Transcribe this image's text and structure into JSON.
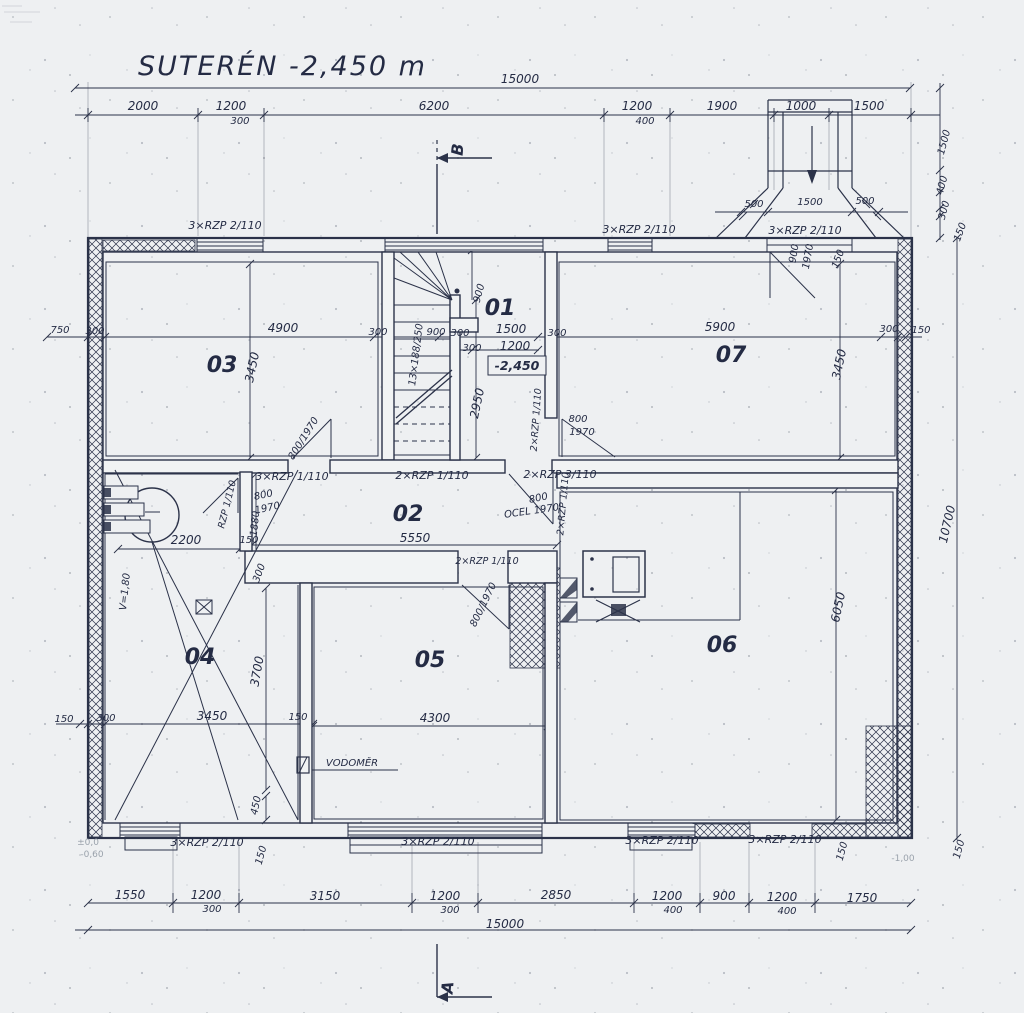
{
  "drawing": {
    "title": "SUTERÉN  -2,450 m",
    "level_mark": "-2,450",
    "room_numbers": [
      "01",
      "02",
      "03",
      "04",
      "05",
      "06",
      "07"
    ],
    "overall_width_mm": "15000",
    "overall_height_mm": "10700",
    "ink_color": "#2b3249",
    "paper_color": "#eef0f2"
  },
  "labels": [
    {
      "t": "SUTERÉN  -2,450 m",
      "x": 138,
      "y": 75,
      "c": "title",
      "n": "drawing-title"
    },
    {
      "t": "15000",
      "x": 520,
      "y": 83,
      "c": "dim"
    },
    {
      "t": "2000",
      "x": 143,
      "y": 110,
      "c": "dim"
    },
    {
      "t": "1200",
      "x": 231,
      "y": 110,
      "c": "dim"
    },
    {
      "t": "300",
      "x": 240,
      "y": 124,
      "c": "dimS"
    },
    {
      "t": "6200",
      "x": 434,
      "y": 110,
      "c": "dim"
    },
    {
      "t": "1200",
      "x": 637,
      "y": 110,
      "c": "dim"
    },
    {
      "t": "400",
      "x": 645,
      "y": 124,
      "c": "dimS"
    },
    {
      "t": "1900",
      "x": 722,
      "y": 110,
      "c": "dim"
    },
    {
      "t": "1000",
      "x": 801,
      "y": 110,
      "c": "dim"
    },
    {
      "t": "1500",
      "x": 869,
      "y": 110,
      "c": "dim"
    },
    {
      "t": "500",
      "x": 754,
      "y": 207,
      "c": "dimS"
    },
    {
      "t": "1500",
      "x": 810,
      "y": 205,
      "c": "dimS"
    },
    {
      "t": "500",
      "x": 865,
      "y": 204,
      "c": "dimS"
    },
    {
      "t": "1500",
      "x": 947,
      "y": 143,
      "r": -75,
      "c": "dimS"
    },
    {
      "t": "400",
      "x": 945,
      "y": 186,
      "r": -75,
      "c": "dimS"
    },
    {
      "t": "300",
      "x": 947,
      "y": 211,
      "r": -75,
      "c": "dimS"
    },
    {
      "t": "150",
      "x": 963,
      "y": 233,
      "r": -70,
      "c": "dimS"
    },
    {
      "t": "10700",
      "x": 951,
      "y": 525,
      "r": -77,
      "c": "dim"
    },
    {
      "t": "3×RZP 2/110",
      "x": 225,
      "y": 229,
      "c": "lint",
      "n": "lintel-label"
    },
    {
      "t": "3×RZP 2/110",
      "x": 639,
      "y": 233,
      "c": "lint",
      "n": "lintel-label"
    },
    {
      "t": "3×RZP 2/110",
      "x": 805,
      "y": 234,
      "c": "lint",
      "n": "lintel-label"
    },
    {
      "t": "900",
      "x": 797,
      "y": 254,
      "r": -80,
      "c": "dimS"
    },
    {
      "t": "1970",
      "x": 811,
      "y": 257,
      "r": -80,
      "c": "dimS"
    },
    {
      "t": "150",
      "x": 841,
      "y": 260,
      "r": -70,
      "c": "dimS"
    },
    {
      "t": "750",
      "x": 60,
      "y": 333,
      "c": "dimS"
    },
    {
      "t": "300",
      "x": 95,
      "y": 334,
      "c": "dimS"
    },
    {
      "t": "4900",
      "x": 283,
      "y": 332,
      "c": "dim"
    },
    {
      "t": "300",
      "x": 378,
      "y": 335,
      "c": "dimS"
    },
    {
      "t": "900",
      "x": 436,
      "y": 335,
      "c": "dimS"
    },
    {
      "t": "300",
      "x": 460,
      "y": 336,
      "c": "dimS"
    },
    {
      "t": "1500",
      "x": 511,
      "y": 333,
      "c": "dim"
    },
    {
      "t": "300",
      "x": 557,
      "y": 336,
      "c": "dimS"
    },
    {
      "t": "300",
      "x": 472,
      "y": 351,
      "c": "dimS"
    },
    {
      "t": "1200",
      "x": 515,
      "y": 350,
      "c": "dim"
    },
    {
      "t": "5900",
      "x": 720,
      "y": 331,
      "c": "dim"
    },
    {
      "t": "300",
      "x": 889,
      "y": 332,
      "c": "dimS"
    },
    {
      "t": "150",
      "x": 921,
      "y": 333,
      "c": "dimS"
    },
    {
      "t": "-2,450",
      "x": 517,
      "y": 370,
      "c": "level",
      "n": "level-mark"
    },
    {
      "t": "900",
      "x": 482,
      "y": 294,
      "r": -75,
      "c": "dimS"
    },
    {
      "t": "2950",
      "x": 481,
      "y": 404,
      "r": -78,
      "c": "dim"
    },
    {
      "t": "13×188/250",
      "x": 419,
      "y": 355,
      "r": -83,
      "c": "dimS",
      "n": "stair-note"
    },
    {
      "t": "03",
      "x": 222,
      "y": 372,
      "c": "room",
      "n": "room-number-03"
    },
    {
      "t": "01",
      "x": 500,
      "y": 315,
      "c": "room",
      "n": "room-number-01"
    },
    {
      "t": "07",
      "x": 731,
      "y": 362,
      "c": "room",
      "n": "room-number-07"
    },
    {
      "t": "02",
      "x": 408,
      "y": 521,
      "c": "room",
      "n": "room-number-02"
    },
    {
      "t": "04",
      "x": 200,
      "y": 664,
      "c": "room",
      "n": "room-number-04"
    },
    {
      "t": "05",
      "x": 430,
      "y": 667,
      "c": "room",
      "n": "room-number-05"
    },
    {
      "t": "06",
      "x": 722,
      "y": 652,
      "c": "room",
      "n": "room-number-06"
    },
    {
      "t": "3450",
      "x": 256,
      "y": 368,
      "r": -78,
      "c": "dim"
    },
    {
      "t": "3450",
      "x": 843,
      "y": 365,
      "r": -78,
      "c": "dim"
    },
    {
      "t": "800/1970",
      "x": 306,
      "y": 440,
      "r": -58,
      "c": "door",
      "n": "door-size-label"
    },
    {
      "t": "800",
      "x": 578,
      "y": 422,
      "c": "door",
      "n": "door-size-label"
    },
    {
      "t": "1970",
      "x": 582,
      "y": 435,
      "c": "door"
    },
    {
      "t": "2×RZP 1/110",
      "x": 539,
      "y": 420,
      "r": -86,
      "c": "lintS",
      "n": "lintel-label"
    },
    {
      "t": "3×RZP 1/110",
      "x": 292,
      "y": 480,
      "c": "lint",
      "n": "lintel-label"
    },
    {
      "t": "2×RZP 1/110",
      "x": 432,
      "y": 479,
      "c": "lint",
      "n": "lintel-label"
    },
    {
      "t": "2×RZP 3/110",
      "x": 560,
      "y": 478,
      "c": "lint",
      "n": "lintel-label"
    },
    {
      "t": "5550",
      "x": 415,
      "y": 542,
      "c": "dim"
    },
    {
      "t": "2×RZP 1/110",
      "x": 487,
      "y": 564,
      "c": "lintS",
      "n": "lintel-label"
    },
    {
      "t": "800/1970",
      "x": 486,
      "y": 606,
      "r": -64,
      "c": "door",
      "n": "door-size-label"
    },
    {
      "t": "800",
      "x": 264,
      "y": 498,
      "r": -12,
      "c": "door",
      "n": "door-size-label"
    },
    {
      "t": "1970",
      "x": 268,
      "y": 511,
      "r": -12,
      "c": "door"
    },
    {
      "t": "RZP 1/110",
      "x": 230,
      "y": 505,
      "r": -76,
      "c": "lintS",
      "n": "lintel-label"
    },
    {
      "t": "1880",
      "x": 258,
      "y": 524,
      "r": -84,
      "c": "dimS"
    },
    {
      "t": "150",
      "x": 249,
      "y": 543,
      "c": "dimS"
    },
    {
      "t": "300",
      "x": 262,
      "y": 574,
      "r": -70,
      "c": "dimS"
    },
    {
      "t": "800",
      "x": 539,
      "y": 501,
      "r": -12,
      "c": "door",
      "n": "door-size-label"
    },
    {
      "t": "OCEL 1970",
      "x": 532,
      "y": 514,
      "r": -8,
      "c": "door",
      "n": "door-size-label"
    },
    {
      "t": "2×RZP 1/110",
      "x": 566,
      "y": 504,
      "r": -85,
      "c": "lintS",
      "n": "lintel-label"
    },
    {
      "t": "2200",
      "x": 186,
      "y": 544,
      "c": "dim"
    },
    {
      "t": "V=1,80",
      "x": 128,
      "y": 592,
      "r": -84,
      "c": "dimS"
    },
    {
      "t": "3700",
      "x": 261,
      "y": 672,
      "r": -80,
      "c": "dim"
    },
    {
      "t": "3450",
      "x": 212,
      "y": 720,
      "c": "dim"
    },
    {
      "t": "150",
      "x": 298,
      "y": 720,
      "c": "dimS"
    },
    {
      "t": "150",
      "x": 64,
      "y": 722,
      "c": "dimS"
    },
    {
      "t": "300",
      "x": 106,
      "y": 721,
      "c": "dimS"
    },
    {
      "t": "450",
      "x": 259,
      "y": 806,
      "r": -78,
      "c": "dimS"
    },
    {
      "t": "4300",
      "x": 435,
      "y": 722,
      "c": "dim"
    },
    {
      "t": "VODOMĚR",
      "x": 352,
      "y": 766,
      "c": "door",
      "n": "vodomer-label"
    },
    {
      "t": "6050",
      "x": 842,
      "y": 608,
      "r": -78,
      "c": "dim"
    },
    {
      "t": "3×RZP 2/110",
      "x": 207,
      "y": 846,
      "c": "lint",
      "n": "lintel-label"
    },
    {
      "t": "150",
      "x": 264,
      "y": 856,
      "r": -75,
      "c": "dimS"
    },
    {
      "t": "3×RZP 2/110",
      "x": 438,
      "y": 845,
      "c": "lint",
      "n": "lintel-label"
    },
    {
      "t": "3×RZP 2/110",
      "x": 662,
      "y": 844,
      "c": "lint",
      "n": "lintel-label"
    },
    {
      "t": "3×RZP 2/110",
      "x": 785,
      "y": 843,
      "c": "lint",
      "n": "lintel-label"
    },
    {
      "t": "150",
      "x": 845,
      "y": 852,
      "r": -75,
      "c": "dimS"
    },
    {
      "t": "150",
      "x": 962,
      "y": 850,
      "r": -75,
      "c": "dimS"
    },
    {
      "t": "±0,0",
      "x": 88,
      "y": 845,
      "c": "faint",
      "n": "level-note"
    },
    {
      "t": "-0,60",
      "x": 92,
      "y": 857,
      "c": "faint",
      "n": "level-note"
    },
    {
      "t": "-1,00",
      "x": 903,
      "y": 861,
      "c": "faint",
      "n": "level-note"
    },
    {
      "t": "1550",
      "x": 130,
      "y": 899,
      "c": "dim"
    },
    {
      "t": "1200",
      "x": 206,
      "y": 899,
      "c": "dim"
    },
    {
      "t": "300",
      "x": 212,
      "y": 912,
      "c": "dimS"
    },
    {
      "t": "3150",
      "x": 325,
      "y": 900,
      "c": "dim"
    },
    {
      "t": "1200",
      "x": 445,
      "y": 900,
      "c": "dim"
    },
    {
      "t": "300",
      "x": 450,
      "y": 913,
      "c": "dimS"
    },
    {
      "t": "2850",
      "x": 556,
      "y": 899,
      "c": "dim"
    },
    {
      "t": "1200",
      "x": 667,
      "y": 900,
      "c": "dim"
    },
    {
      "t": "400",
      "x": 673,
      "y": 913,
      "c": "dimS"
    },
    {
      "t": "900",
      "x": 724,
      "y": 900,
      "c": "dim"
    },
    {
      "t": "1200",
      "x": 782,
      "y": 901,
      "c": "dim"
    },
    {
      "t": "400",
      "x": 787,
      "y": 914,
      "c": "dimS"
    },
    {
      "t": "1750",
      "x": 862,
      "y": 902,
      "c": "dim"
    },
    {
      "t": "15000",
      "x": 505,
      "y": 928,
      "c": "dim"
    },
    {
      "t": "B",
      "x": 463,
      "y": 150,
      "r": -85,
      "c": "mark",
      "n": "section-marker-b"
    },
    {
      "t": "A",
      "x": 453,
      "y": 988,
      "r": -85,
      "c": "mark",
      "n": "section-marker-a"
    }
  ]
}
